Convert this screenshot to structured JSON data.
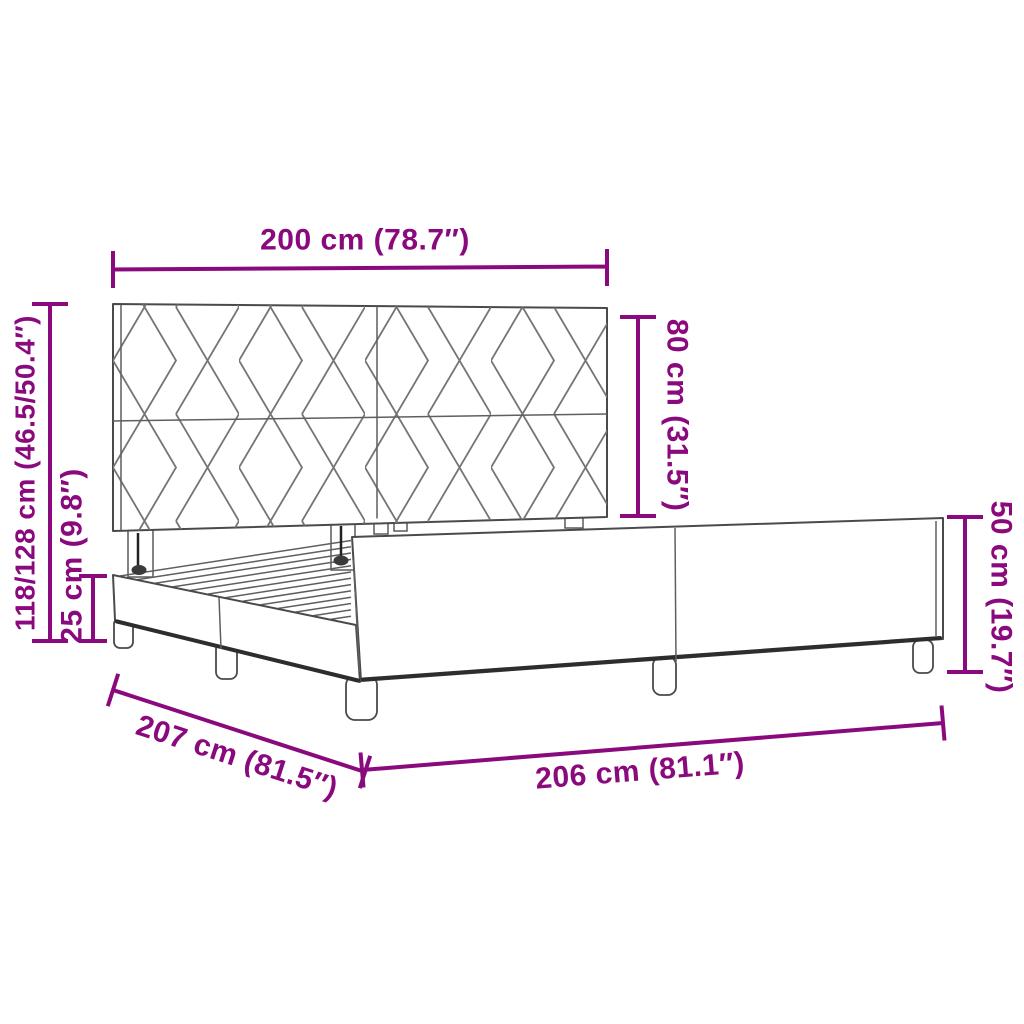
{
  "diagram": {
    "kind": "bed-frame-dimension-diagram",
    "accent_color": "#8a0a7d",
    "line_color": "#4a4a4a",
    "background_color": "#ffffff",
    "labels": {
      "headboard_width": "200 cm (78.7″)",
      "headboard_height": "80 cm (31.5″)",
      "overall_height": "118/128 cm (46.5/50.4″)",
      "side_rail_height": "25 cm (9.8″)",
      "frame_length": "207 cm (81.5″)",
      "frame_width": "206 cm (81.1″)",
      "footboard_height": "50 cm (19.7″)"
    }
  }
}
